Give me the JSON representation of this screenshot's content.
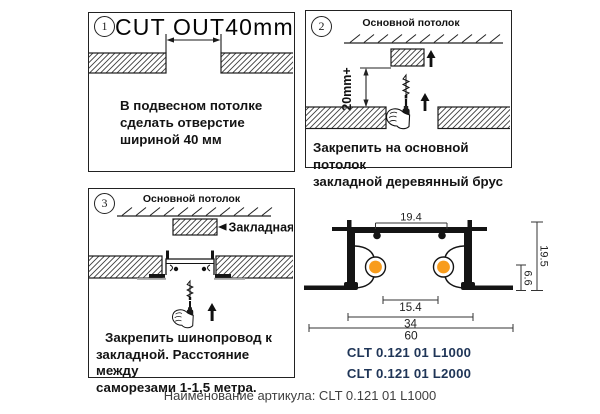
{
  "sheet": {
    "footer": "Наименование артикула: CLT 0.121 01 L1000"
  },
  "panel1": {
    "number": "1",
    "title": "CUT OUT40mm",
    "caption_lines": [
      "В подвесном потолке",
      "сделать отверстие",
      "шириной 40 мм"
    ]
  },
  "panel2": {
    "number": "2",
    "ceiling_label": "Основной потолок",
    "dim_label": "20mm+",
    "caption_lines": [
      "Закрепить на основной потолок",
      "закладной деревянный брус"
    ]
  },
  "panel3": {
    "number": "3",
    "ceiling_label": "Основной потолок",
    "callout_label": "Закладная",
    "caption_lines": [
      "Закрепить шинопровод к",
      "закладной. Расстояние между",
      "саморезами 1-1,5 метра."
    ]
  },
  "profile": {
    "dim_top": "19.4",
    "dim_inner": "15.4",
    "dim_mid": "34",
    "dim_outer": "60",
    "dim_height": "19.5",
    "dim_lower": "6.6",
    "articles": [
      "CLT 0.121 01 L1000",
      "CLT 0.121 01 L2000"
    ],
    "accent_color": "#F89C1C"
  }
}
